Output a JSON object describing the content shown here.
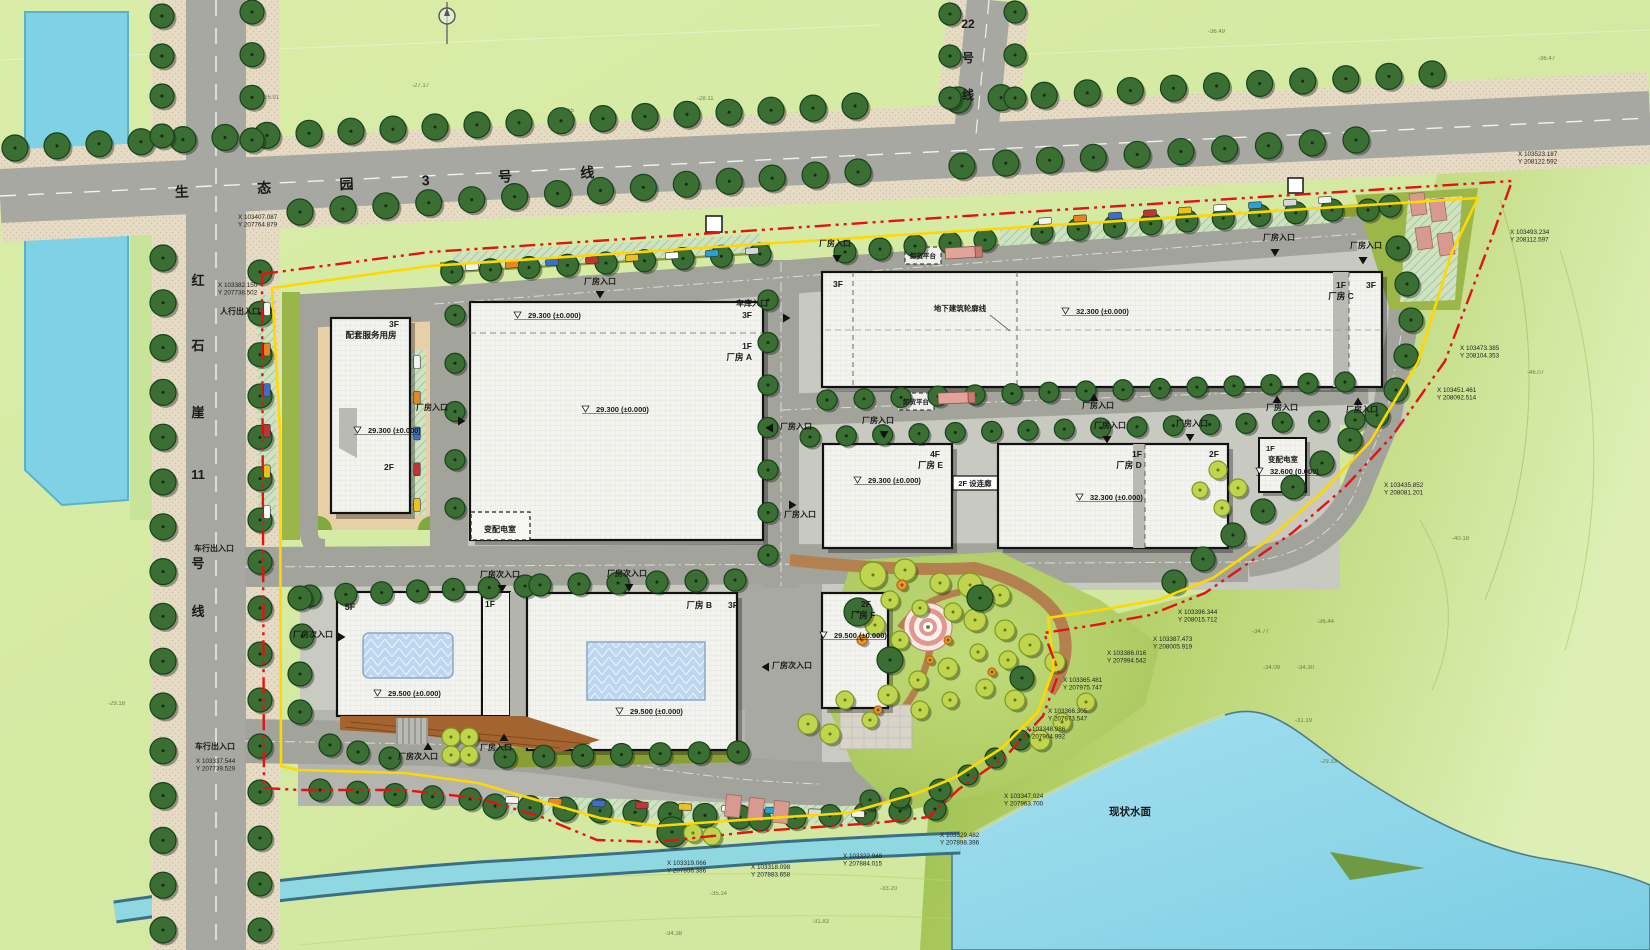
{
  "plan": {
    "road_names": {
      "main": "生 态 园 3 号 线",
      "west_vertical": [
        "红",
        "石",
        "崖",
        "11",
        "号",
        "线"
      ],
      "north_vertical": [
        "22",
        "号",
        "线"
      ]
    },
    "labels": {
      "factory_entrance": "厂房入口",
      "factory_sub_entrance": "厂房次入口",
      "garage_entrance": "车库入口",
      "pedestrian_entrance": "人行出入口",
      "vehicle_entrance": "车行出入口",
      "unloading_platform": "卸货平台",
      "underground_outline": "地下建筑轮廓线",
      "existing_water": "现状水面"
    },
    "buildings": {
      "service": {
        "floor_top": "3F",
        "name": "配套服务用房",
        "floor_bottom": "2F"
      },
      "a": {
        "floor_top": "3F",
        "floor": "1F",
        "name": "厂房 A"
      },
      "b": {
        "name": "厂房 B",
        "floor": "3F"
      },
      "b_wing": {
        "floor": "1F"
      },
      "tower": {
        "floor": "5F"
      },
      "c": {
        "floor_left": "3F",
        "floor": "1F",
        "name": "厂房 C",
        "floor_right": "3F"
      },
      "d": {
        "floor": "1F",
        "name": "厂房 D",
        "floor_alt": "2F"
      },
      "e": {
        "floor": "4F",
        "name": "厂房 E"
      },
      "f": {
        "floor": "2F",
        "name": "厂房 F"
      },
      "corridor": {
        "label": "2F 设连廊"
      },
      "substation_a": {
        "name": "变配电室"
      },
      "substation_e": {
        "floor": "1F",
        "name": "变配电室"
      }
    },
    "entrances": [
      {
        "x": 600,
        "y": 284,
        "key": "factory_entrance",
        "ax": 600,
        "ay": 294,
        "dir": "down"
      },
      {
        "x": 835,
        "y": 246,
        "key": "factory_entrance",
        "ax": 837,
        "ay": 258,
        "dir": "down"
      },
      {
        "x": 1279,
        "y": 240,
        "key": "factory_entrance",
        "ax": 1275,
        "ay": 252,
        "dir": "down"
      },
      {
        "x": 1366,
        "y": 248,
        "key": "factory_entrance",
        "ax": 1363,
        "ay": 260,
        "dir": "down"
      },
      {
        "x": 752,
        "y": 306,
        "key": "garage_entrance",
        "ax": 786,
        "ay": 318,
        "dir": "right"
      },
      {
        "x": 432,
        "y": 410,
        "key": "factory_entrance",
        "ax": 461,
        "ay": 421,
        "dir": "right"
      },
      {
        "x": 796,
        "y": 429,
        "key": "factory_entrance",
        "ax": 770,
        "ay": 428,
        "dir": "left"
      },
      {
        "x": 878,
        "y": 423,
        "key": "factory_entrance",
        "ax": 884,
        "ay": 434,
        "dir": "down"
      },
      {
        "x": 1098,
        "y": 408,
        "key": "factory_entrance",
        "ax": 1094,
        "ay": 398,
        "dir": "up"
      },
      {
        "x": 1110,
        "y": 428,
        "key": "factory_entrance",
        "ax": 1107,
        "ay": 439,
        "dir": "down"
      },
      {
        "x": 1282,
        "y": 410,
        "key": "factory_entrance",
        "ax": 1277,
        "ay": 400,
        "dir": "up"
      },
      {
        "x": 1362,
        "y": 412,
        "key": "factory_entrance",
        "ax": 1358,
        "ay": 402,
        "dir": "up"
      },
      {
        "x": 1192,
        "y": 426,
        "key": "factory_entrance",
        "ax": 1190,
        "ay": 437,
        "dir": "down"
      },
      {
        "x": 800,
        "y": 517,
        "key": "factory_entrance",
        "ax": 792,
        "ay": 505,
        "dir": "right"
      },
      {
        "x": 500,
        "y": 577,
        "key": "factory_sub_entrance",
        "ax": 502,
        "ay": 588,
        "dir": "down"
      },
      {
        "x": 627,
        "y": 576,
        "key": "factory_sub_entrance",
        "ax": 629,
        "ay": 587,
        "dir": "down"
      },
      {
        "x": 313,
        "y": 637,
        "key": "factory_sub_entrance",
        "ax": 341,
        "ay": 637,
        "dir": "right"
      },
      {
        "x": 792,
        "y": 668,
        "key": "factory_sub_entrance",
        "ax": 766,
        "ay": 667,
        "dir": "left"
      },
      {
        "x": 418,
        "y": 759,
        "key": "factory_sub_entrance",
        "ax": 428,
        "ay": 747,
        "dir": "up"
      },
      {
        "x": 496,
        "y": 750,
        "key": "factory_entrance",
        "ax": 504,
        "ay": 738,
        "dir": "up"
      },
      {
        "x": 240,
        "y": 314,
        "key": "pedestrian_entrance"
      },
      {
        "x": 214,
        "y": 551,
        "key": "vehicle_entrance"
      },
      {
        "x": 215,
        "y": 749,
        "key": "vehicle_entrance"
      }
    ],
    "elevation_marks": [
      {
        "x": 368,
        "y": 433,
        "text": "29.300 (±0.000)"
      },
      {
        "x": 528,
        "y": 318,
        "text": "29.300 (±0.000)"
      },
      {
        "x": 596,
        "y": 412,
        "text": "29.300 (±0.000)"
      },
      {
        "x": 1076,
        "y": 314,
        "text": "32.300 (±0.000)"
      },
      {
        "x": 868,
        "y": 483,
        "text": "29.300 (±0.000)"
      },
      {
        "x": 1090,
        "y": 500,
        "text": "32.300 (±0.000)"
      },
      {
        "x": 1270,
        "y": 474,
        "text": "32.600 (0.000)"
      },
      {
        "x": 388,
        "y": 696,
        "text": "29.500 (±0.000)"
      },
      {
        "x": 630,
        "y": 714,
        "text": "29.500 (±0.000)"
      },
      {
        "x": 834,
        "y": 638,
        "text": "29.500 (±0.000)"
      }
    ],
    "coordinates": [
      {
        "x": 1518,
        "y": 156,
        "x_label": "X 103523.187",
        "y_label": "Y 208122.592"
      },
      {
        "x": 1510,
        "y": 234,
        "x_label": "X 103493.234",
        "y_label": "Y 208112.597"
      },
      {
        "x": 1460,
        "y": 350,
        "x_label": "X 103473.385",
        "y_label": "Y 208104.353"
      },
      {
        "x": 1437,
        "y": 392,
        "x_label": "X 103451.461",
        "y_label": "Y 208092.514"
      },
      {
        "x": 1384,
        "y": 487,
        "x_label": "X 103435.852",
        "y_label": "Y 208081.201"
      },
      {
        "x": 1178,
        "y": 614,
        "x_label": "X 103396.344",
        "y_label": "Y 208015.712"
      },
      {
        "x": 1153,
        "y": 641,
        "x_label": "X 103387.473",
        "y_label": "Y 208005.919"
      },
      {
        "x": 1107,
        "y": 655,
        "x_label": "X 103386.016",
        "y_label": "Y 207994.542"
      },
      {
        "x": 1063,
        "y": 682,
        "x_label": "X 103365.481",
        "y_label": "Y 207975.747"
      },
      {
        "x": 1048,
        "y": 713,
        "x_label": "X 103366.305",
        "y_label": "Y 207973.547"
      },
      {
        "x": 1026,
        "y": 731,
        "x_label": "X 103348.986",
        "y_label": "Y 207964.992"
      },
      {
        "x": 1004,
        "y": 798,
        "x_label": "X 103347.024",
        "y_label": "Y 207963.700"
      },
      {
        "x": 667,
        "y": 865,
        "x_label": "X 103319.066",
        "y_label": "Y 207856.386"
      },
      {
        "x": 751,
        "y": 869,
        "x_label": "X 103318.098",
        "y_label": "Y 207883.658"
      },
      {
        "x": 843,
        "y": 858,
        "x_label": "X 103322.948",
        "y_label": "Y 207884.015"
      },
      {
        "x": 940,
        "y": 837,
        "x_label": "X 103329.482",
        "y_label": "Y 207898.396"
      },
      {
        "x": 238,
        "y": 219,
        "x_label": "X 103407.087",
        "y_label": "Y 207764.879"
      },
      {
        "x": 218,
        "y": 287,
        "x_label": "X 103382.150",
        "y_label": "Y 207738.502"
      },
      {
        "x": 196,
        "y": 763,
        "x_label": "X 103337.544",
        "y_label": "Y 207739.529"
      }
    ],
    "spot_levels": [
      {
        "x": 262,
        "y": 99,
        "value": "-26.91"
      },
      {
        "x": 412,
        "y": 87,
        "value": "-27.17"
      },
      {
        "x": 557,
        "y": 112,
        "value": "-27.55"
      },
      {
        "x": 697,
        "y": 100,
        "value": "-28.11"
      },
      {
        "x": 1208,
        "y": 33,
        "value": "-36.49"
      },
      {
        "x": 1538,
        "y": 60,
        "value": "-36.47"
      },
      {
        "x": 1527,
        "y": 374,
        "value": "-46.07"
      },
      {
        "x": 1452,
        "y": 540,
        "value": "-40.18"
      },
      {
        "x": 1317,
        "y": 623,
        "value": "-36.44"
      },
      {
        "x": 1252,
        "y": 633,
        "value": "-34.77"
      },
      {
        "x": 1263,
        "y": 669,
        "value": "-34.09"
      },
      {
        "x": 1297,
        "y": 669,
        "value": "-34.30"
      },
      {
        "x": 1295,
        "y": 722,
        "value": "-31.19"
      },
      {
        "x": 1320,
        "y": 763,
        "value": "-29.33"
      },
      {
        "x": 710,
        "y": 895,
        "value": "-35.14"
      },
      {
        "x": 880,
        "y": 890,
        "value": "-33.20"
      },
      {
        "x": 812,
        "y": 923,
        "value": "-31.83"
      },
      {
        "x": 665,
        "y": 935,
        "value": "-34.38"
      },
      {
        "x": 108,
        "y": 705,
        "value": "-29.18"
      }
    ]
  }
}
